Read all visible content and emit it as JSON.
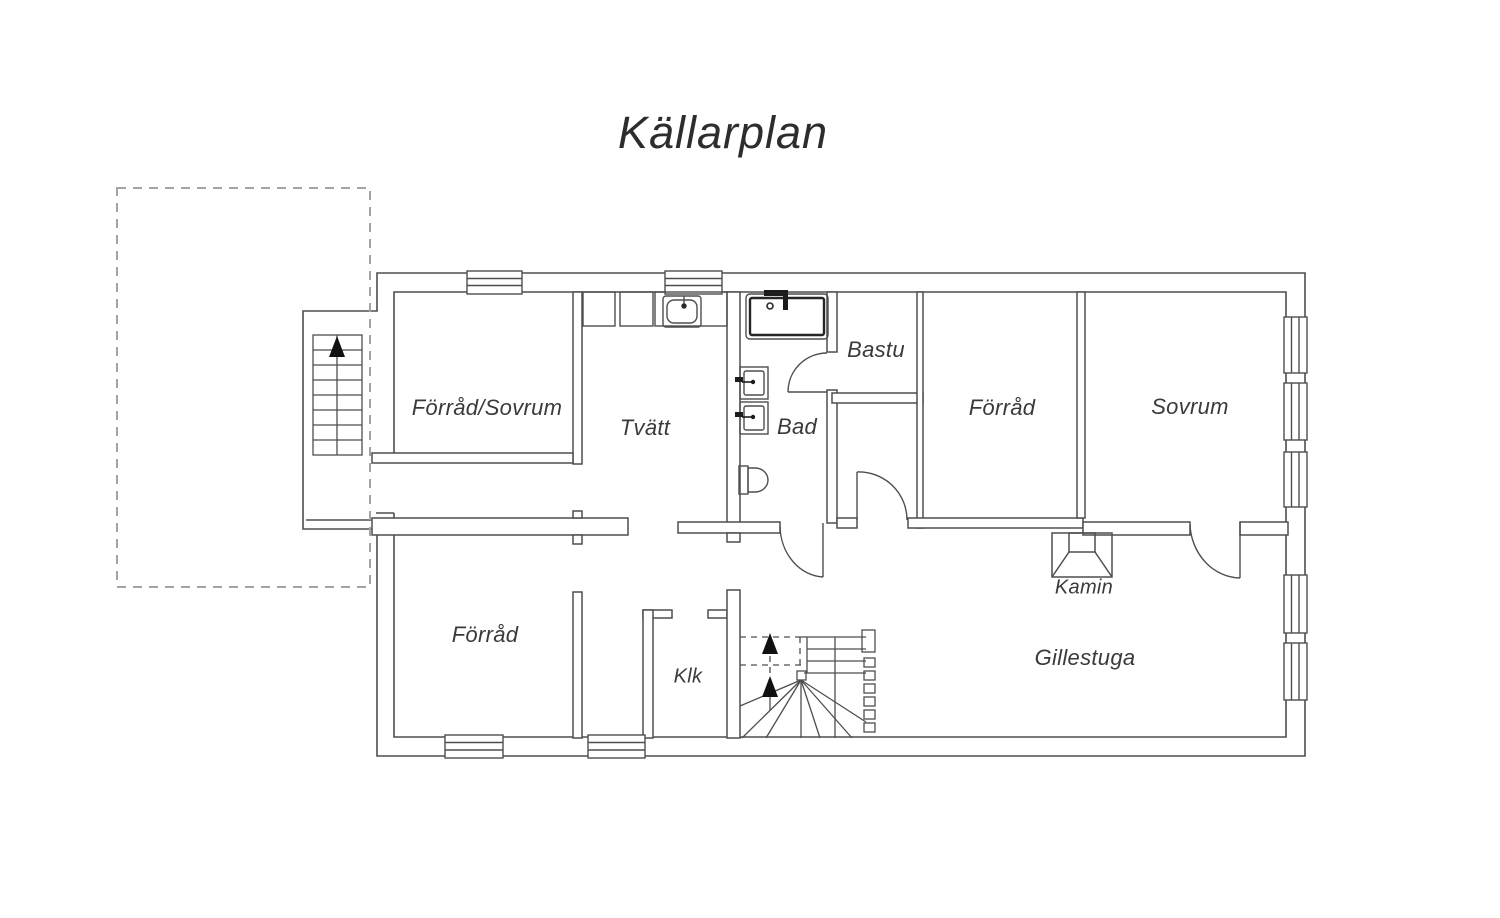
{
  "title": "Källarplan",
  "colors": {
    "wall_line": "#4d4e50",
    "text": "#3a3a3c",
    "dashed_outline": "#a3a3a3",
    "fixture_dark": "#1c1c1c",
    "background": "#ffffff"
  },
  "rooms": [
    {
      "id": "forrad-sovrum",
      "label": "Förråd/Sovrum"
    },
    {
      "id": "tvatt",
      "label": "Tvätt"
    },
    {
      "id": "bad",
      "label": "Bad"
    },
    {
      "id": "bastu",
      "label": "Bastu"
    },
    {
      "id": "forrad-top",
      "label": "Förråd"
    },
    {
      "id": "sovrum",
      "label": "Sovrum"
    },
    {
      "id": "kamin",
      "label": "Kamin"
    },
    {
      "id": "forrad-bottom",
      "label": "Förråd"
    },
    {
      "id": "klk",
      "label": "Klk"
    },
    {
      "id": "gillestuga",
      "label": "Gillestuga"
    }
  ],
  "icons": {
    "stairs_up_arrow": "filled up-pointing triangle",
    "window_symbol": "double-line wall window",
    "door_symbol": "quarter-circle swing arc"
  },
  "fixtures": [
    "bathtub",
    "sink",
    "washbasin",
    "washbasin",
    "toilet",
    "fireplace"
  ]
}
